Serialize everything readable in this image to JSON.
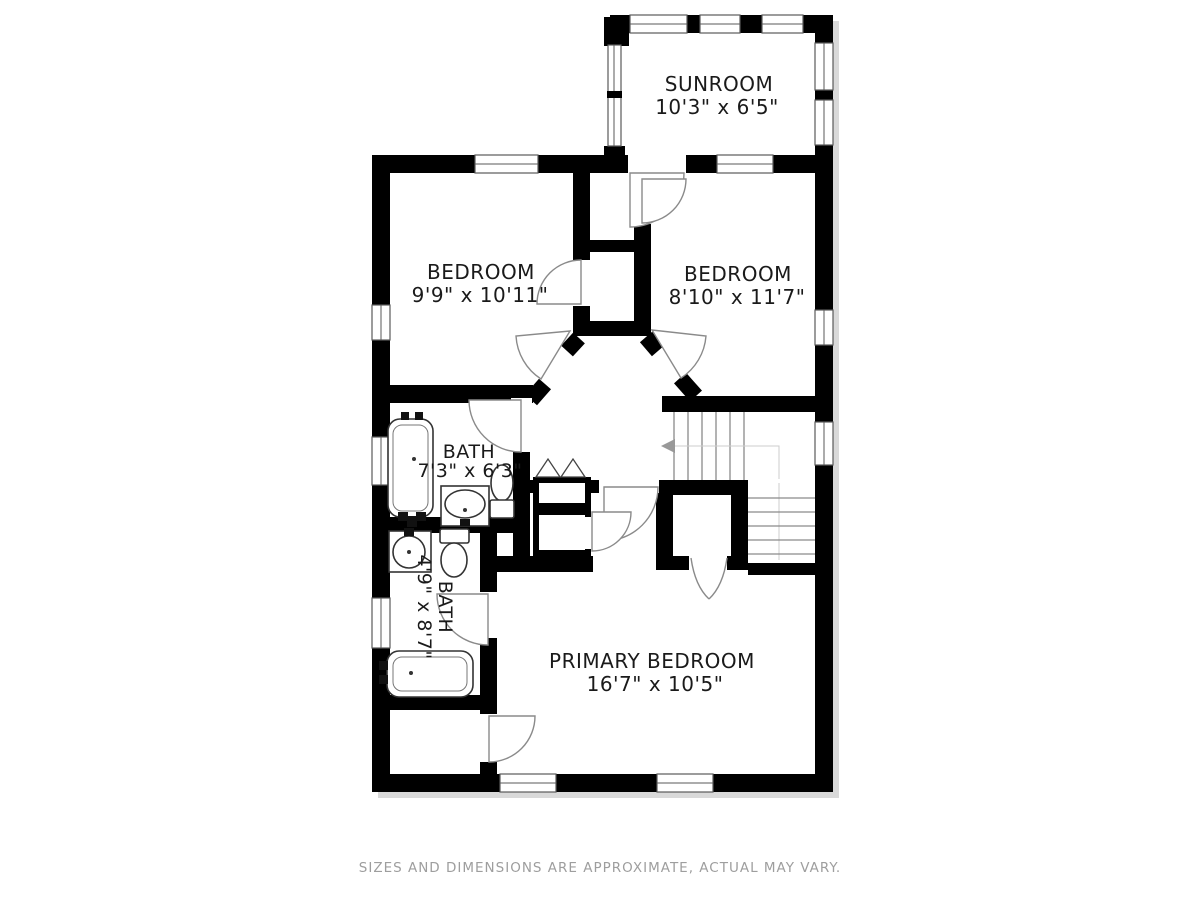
{
  "title": "Second floor plan",
  "colors": {
    "wall": "#000000",
    "label": "#1a1a1a",
    "door_stroke": "#8a8a8a",
    "fixture_stroke": "#333333",
    "guide": "#cccccc",
    "footer": "#9e9e9e",
    "shadow": "#d9d9d9",
    "background": "#ffffff"
  },
  "rooms": {
    "sunroom": {
      "name": "SUNROOM",
      "dims": "10'3\" x 6'5\""
    },
    "bedroom_left": {
      "name": "BEDROOM",
      "dims": "9'9\" x 10'11\""
    },
    "bedroom_right": {
      "name": "BEDROOM",
      "dims": "8'10\" x 11'7\""
    },
    "bath_upper": {
      "name": "BATH",
      "dims": "7'3\" x 6'3\""
    },
    "bath_lower": {
      "name": "BATH",
      "dims": "4'9\" x 8'7\""
    },
    "primary_bedroom": {
      "name": "PRIMARY BEDROOM",
      "dims": "16'7\" x 10'5\""
    }
  },
  "stairs": {
    "direction": "left"
  },
  "footer": {
    "disclaimer": "SIZES AND DIMENSIONS ARE APPROXIMATE, ACTUAL MAY VARY."
  }
}
